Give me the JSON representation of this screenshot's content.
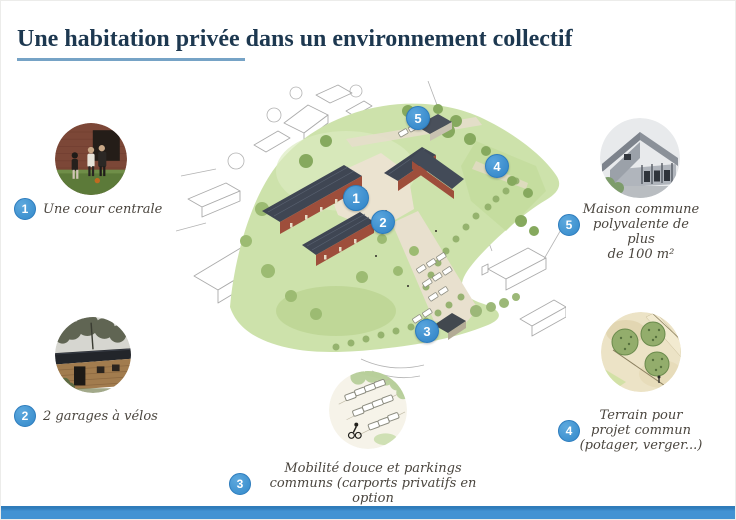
{
  "header": {
    "title": "Une habitation privée dans un environnement collectif"
  },
  "theme": {
    "title_color": "#1d3850",
    "underline_color": "#76a3c6",
    "accent_bar_color": "#4292d3",
    "marker_badge_color": "#3a8ecd",
    "label_color": "#4a453e"
  },
  "legend": {
    "items": [
      {
        "number": "1",
        "label": "Une cour centrale",
        "photo_name": "central-courtyard-photo"
      },
      {
        "number": "2",
        "label": "2 garages à vélos",
        "photo_name": "bike-garage-photo"
      },
      {
        "number": "3",
        "label": "Mobilité douce et parkings\ncommuns (carports privatifs en option\net soumis à l'accord de la copropriété)",
        "photo_name": "soft-mobility-parking-sketch"
      },
      {
        "number": "4",
        "label": "Terrain pour\nprojet commun\n(potager, verger...)",
        "photo_name": "common-land-sketch"
      },
      {
        "number": "5",
        "label": "Maison commune\npolyvalente de plus\nde 100 m²",
        "photo_name": "common-house-photo"
      }
    ]
  },
  "map": {
    "markers": [
      {
        "number": "1"
      },
      {
        "number": "2"
      },
      {
        "number": "3"
      },
      {
        "number": "4"
      },
      {
        "number": "5"
      }
    ]
  }
}
